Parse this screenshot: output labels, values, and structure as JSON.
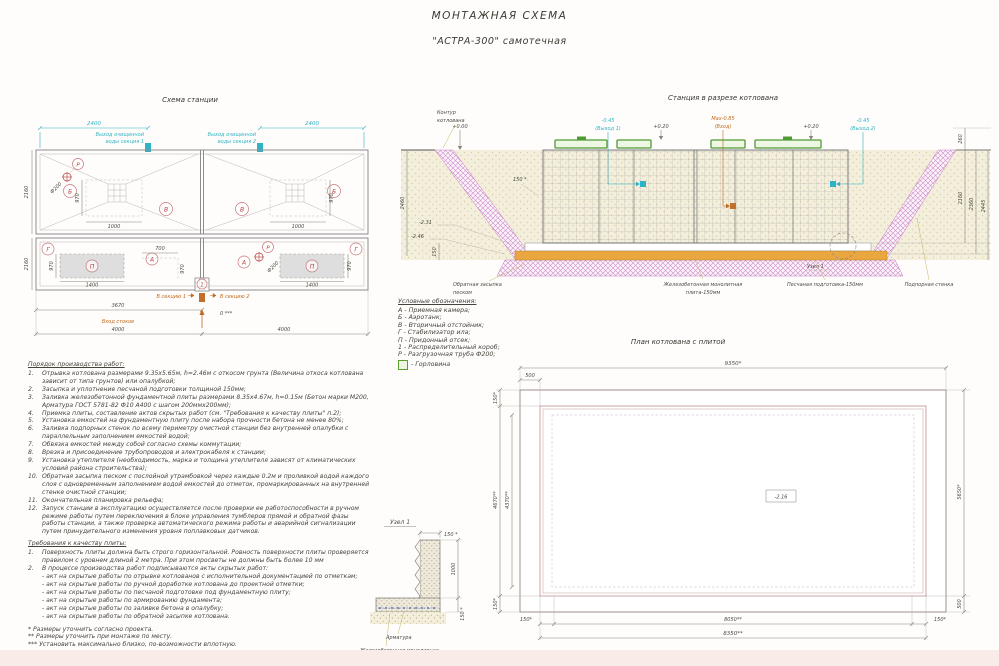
{
  "title": {
    "main": "МОНТАЖНАЯ СХЕМА",
    "sub": "\"АСТРА-300\" самотечная"
  },
  "station_plan": {
    "title": "Схема станции",
    "dim_2400_left": "2400",
    "dim_2400_right": "2400",
    "outlet1_line1": "Выход очищенной",
    "outlet1_line2": "воды секция 1",
    "outlet2_line1": "Выход очищенной",
    "outlet2_line2": "воды секция 2",
    "dim_2160_top": "2160",
    "dim_2160_bottom": "2160",
    "dim_970_top_left": "970",
    "dim_1000_left": "1000",
    "dim_970_top_right": "970",
    "dim_1000_right": "1000",
    "letter_b1": "Б",
    "letter_v1": "В",
    "letter_v2": "В",
    "letter_b2": "Б",
    "letter_g1": "Г",
    "letter_a1": "А",
    "letter_p1": "П",
    "letter_a2": "А",
    "letter_p2": "П",
    "letter_g2": "Г",
    "letter_r1": "Р",
    "letter_r2": "Р",
    "letter_k": "1",
    "fi200_top": "Ф200",
    "fi200_bottom": "Ф200",
    "dim_970_bot_left": "970",
    "dim_1400_left": "1400",
    "dim_700": "700",
    "dim_970_center": "970",
    "dim_970_bot_right": "970",
    "dim_1400_right": "1400",
    "to_section1": "В секцию 1",
    "to_section2": "В секцию 2",
    "dim_3670": "3670",
    "inlet_label": "Вход стоков",
    "zero_mark": "0 ***",
    "dim_4000_left": "4000",
    "dim_4000_right": "4000"
  },
  "section_view": {
    "title": "Станция в разрезе котлована",
    "contour_line1": "Контур",
    "contour_line2": "котлована",
    "elev_000": "+0.00",
    "elev_045_1": "-0.45",
    "outlet1": "(Выход 1)",
    "elev_020_1": "+0.20",
    "elev_max": "Мах-0.85",
    "inlet": "(Вход)",
    "elev_020_2": "+0.20",
    "elev_045_2": "-0.45",
    "outlet2": "(Выход 2)",
    "dim_260": "260",
    "dim_2160": "2160",
    "dim_2360": "2360",
    "dim_2445": "2445",
    "dim_2460": "2460",
    "dim_150_star": "150 *",
    "elev_231": "-2.31",
    "elev_246": "-2.46",
    "dim_150": "150",
    "backfill_line1": "Обратная засыпка",
    "backfill_line2": "песком",
    "slab_line1": "Железобетонная монолитная",
    "slab_line2": "плита-150мм",
    "sand_label": "Песчаная подготовка-150мм",
    "node_label": "Узел 1",
    "wall_label": "Подпорная стенка"
  },
  "legend": {
    "title": "Условные обозначения:",
    "items": [
      "А -  Приемная камера;",
      "Б -  Аэротанк;",
      "В -  Вторичный отстойник;",
      "Г -  Стабилизатор ила;",
      "П -  Придонный отсек;",
      "1 -  Распределительный короб;",
      "Р -  Разгрузочная труба Ф200;"
    ],
    "gorlovina": "-  Горловина"
  },
  "work_order": {
    "title": "Порядок производства работ:",
    "items": [
      {
        "n": "1.",
        "text": "Отрывка котлована размерами 9.35х5.65м, h=2.46м с откосом грунта (Величина откоса котлована зависит от типа грунтов) или опалубкой;"
      },
      {
        "n": "2.",
        "text": "Засыпка и уплотнение песчаной подготовки толщиной 150мм;"
      },
      {
        "n": "3.",
        "text": "Заливка железобетонной фундаментной плиты размерами 8.35х4.67м, h=0.15м (Бетон марки М200, Арматура ГОСТ 5781-82 Ф10 А400 с шагом 200ммх200мм);"
      },
      {
        "n": "4.",
        "text": "Приемка плиты, составление актов скрытых работ (см. \"Требования к качеству плиты\" п.2);"
      },
      {
        "n": "5.",
        "text": "Установка емкостей на фундаментную плиту после набора прочности бетона не менее 80%;"
      },
      {
        "n": "6.",
        "text": "Заливка подпорных стенок по всему периметру очистной станции без внутренней опалубки с параллельным заполнением емкостей водой;"
      },
      {
        "n": "7.",
        "text": "Обвязка емкостей между собой согласно схемы коммутации;"
      },
      {
        "n": "8.",
        "text": "Врезка и присоединение трубопроводов и электрокабеля к станции;"
      },
      {
        "n": "9.",
        "text": "Установка утеплителя (необходимость, марка и толщина утеплителя зависят от климатических условий района строительства);"
      },
      {
        "n": "10.",
        "text": "Обратная засыпка песком с послойной утрамбовкой через каждые 0.2м и проливкой водой каждого слоя с одновременным заполнением водой емкостей до отметок, промаркированных на внутренней стенке очистной станции;"
      },
      {
        "n": "11.",
        "text": "Окончательная планировка рельефа;"
      },
      {
        "n": "12.",
        "text": "Запуск станции в эксплуатацию осуществляется после проверки ее работоспособности в ручном режиме работы путем переключения в блоке управления тумблеров прямой и обратной фазы работы станции, а также проверка автоматического режима работы и аварийной сигнализации путем принудительного изменения уровня поплавковых датчиков."
      }
    ]
  },
  "quality": {
    "title": "Требования к качеству плиты:",
    "item1_n": "1.",
    "item1": "Поверхность плиты должна быть строго горизонтальной. Ровность поверхности плиты проверяется правилом с уровнем длиной 2 метра. При этом просветы не должны быть  более 10 мм",
    "item2_n": "2.",
    "item2": "В процессе производства работ подписываются акты скрытых работ:",
    "acts": [
      "- акт на скрытые работы по отрывке котлованов с исполнительной документацией по отметкам;",
      "- акт на скрытые работы по ручной доработке котлована до проектной отметки;",
      "- акт на скрытые работы по песчаной подготовке под фундаментную плиту;",
      "- акт на скрытые работы по армированию фундамента;",
      "- акт на скрытые работы по заливке бетона в опалубку;",
      "- акт на скрытые работы по обратной засыпке котлована."
    ]
  },
  "footnotes": [
    "*  Размеры уточнить согласно проекта.",
    "**  Размеры уточнить при монтаже по месту.",
    "***  Установить максимально близко, по-возможности вплотную."
  ],
  "pit_plan": {
    "title": "План котлована с плитой",
    "dim_9350": "9350*",
    "dim_500_top": "500",
    "dim_150_tl": "150*",
    "dim_4670": "4670**",
    "dim_4370": "4370**",
    "dim_150_bl": "150*",
    "dim_150_b1": "150*",
    "dim_8050": "8050**",
    "dim_150_b2": "150*",
    "dim_8350": "8350**",
    "dim_5650": "5650*",
    "dim_500_bottom": "500",
    "elev": "-2.16"
  },
  "node_detail": {
    "title": "Узел 1",
    "dim_150_top": "150 *",
    "dim_1000": "1000",
    "dim_150_bottom": "150 *",
    "rebar_label": "Арматура",
    "slab_line1": "Железобетонная монолитная",
    "slab_line2": "плита-150мм"
  },
  "colors": {
    "cyan": "#2fb3c2",
    "orange": "#c06a1e",
    "red_marks": "#b4403a",
    "pink_hatch": "#cf8cc8",
    "sand": "#f3eeda",
    "sand_layer": "#eaa63f",
    "green": "#5aa132"
  }
}
